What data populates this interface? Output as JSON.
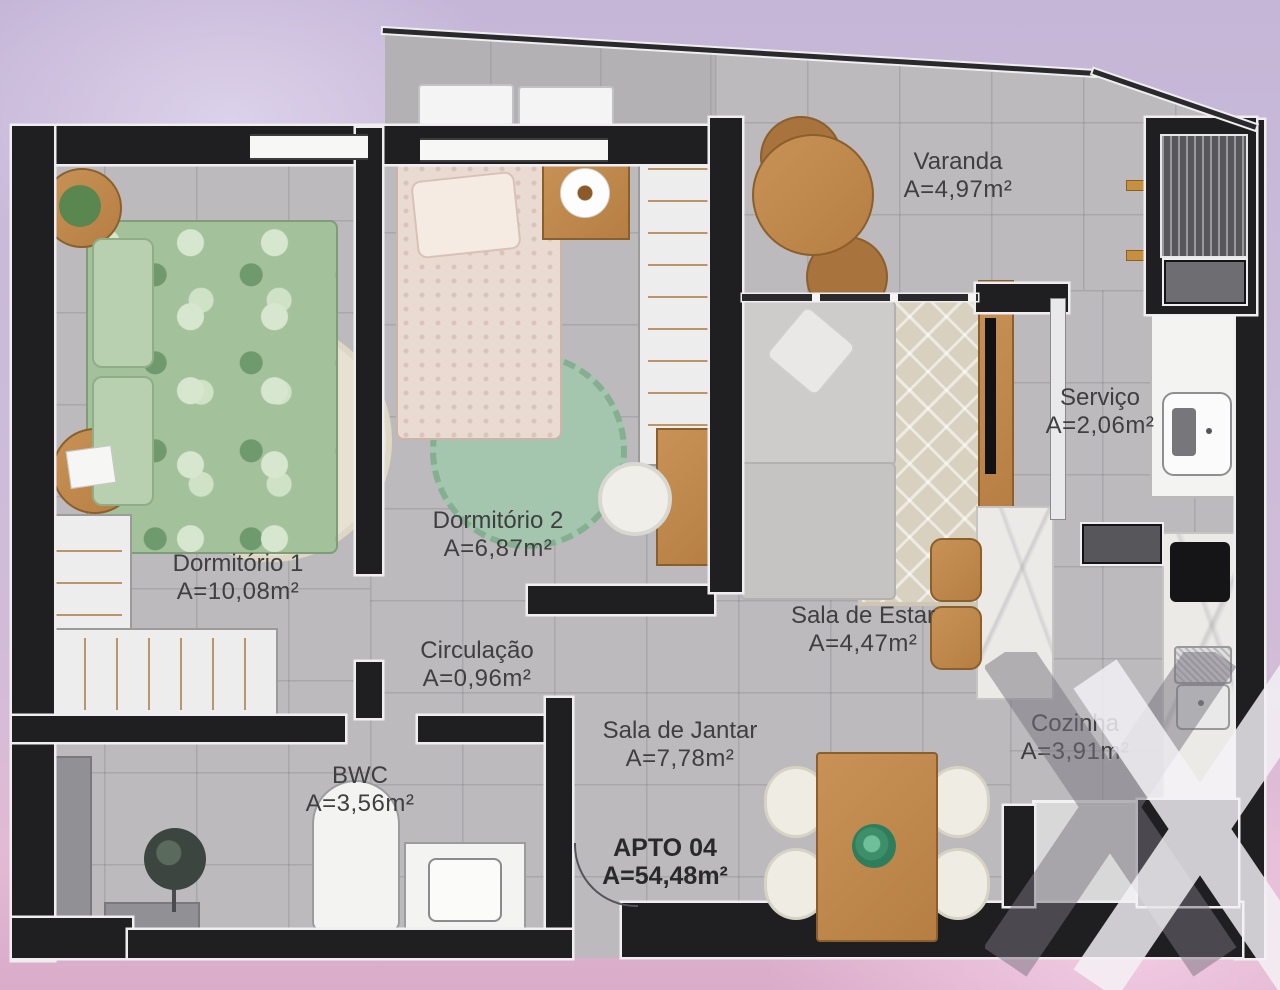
{
  "unit": {
    "label": "APTO 04",
    "area": "A=54,48m²"
  },
  "rooms": [
    {
      "label": "Varanda",
      "area": "A=4,97m²"
    },
    {
      "label": "Serviço",
      "area": "A=2,06m²"
    },
    {
      "label": "Dormitório 1",
      "area": "A=10,08m²"
    },
    {
      "label": "Dormitório 2",
      "area": "A=6,87m²"
    },
    {
      "label": "Circulação",
      "area": "A=0,96m²"
    },
    {
      "label": "Sala de Estar",
      "area": "A=4,47m²"
    },
    {
      "label": "Sala de Jantar",
      "area": "A=7,78m²"
    },
    {
      "label": "BWC",
      "area": "A=3,56m²"
    },
    {
      "label": "Cozinha",
      "area": "A=3,91m²"
    }
  ],
  "colors": {
    "background_top": "#c5b6d7",
    "background_bottom": "#d9acc9",
    "floor": "#bcbabd",
    "walls": "#1f1e21",
    "wood": "#bd8648",
    "label_text": "#3f3e40"
  },
  "watermark": "x-logo"
}
